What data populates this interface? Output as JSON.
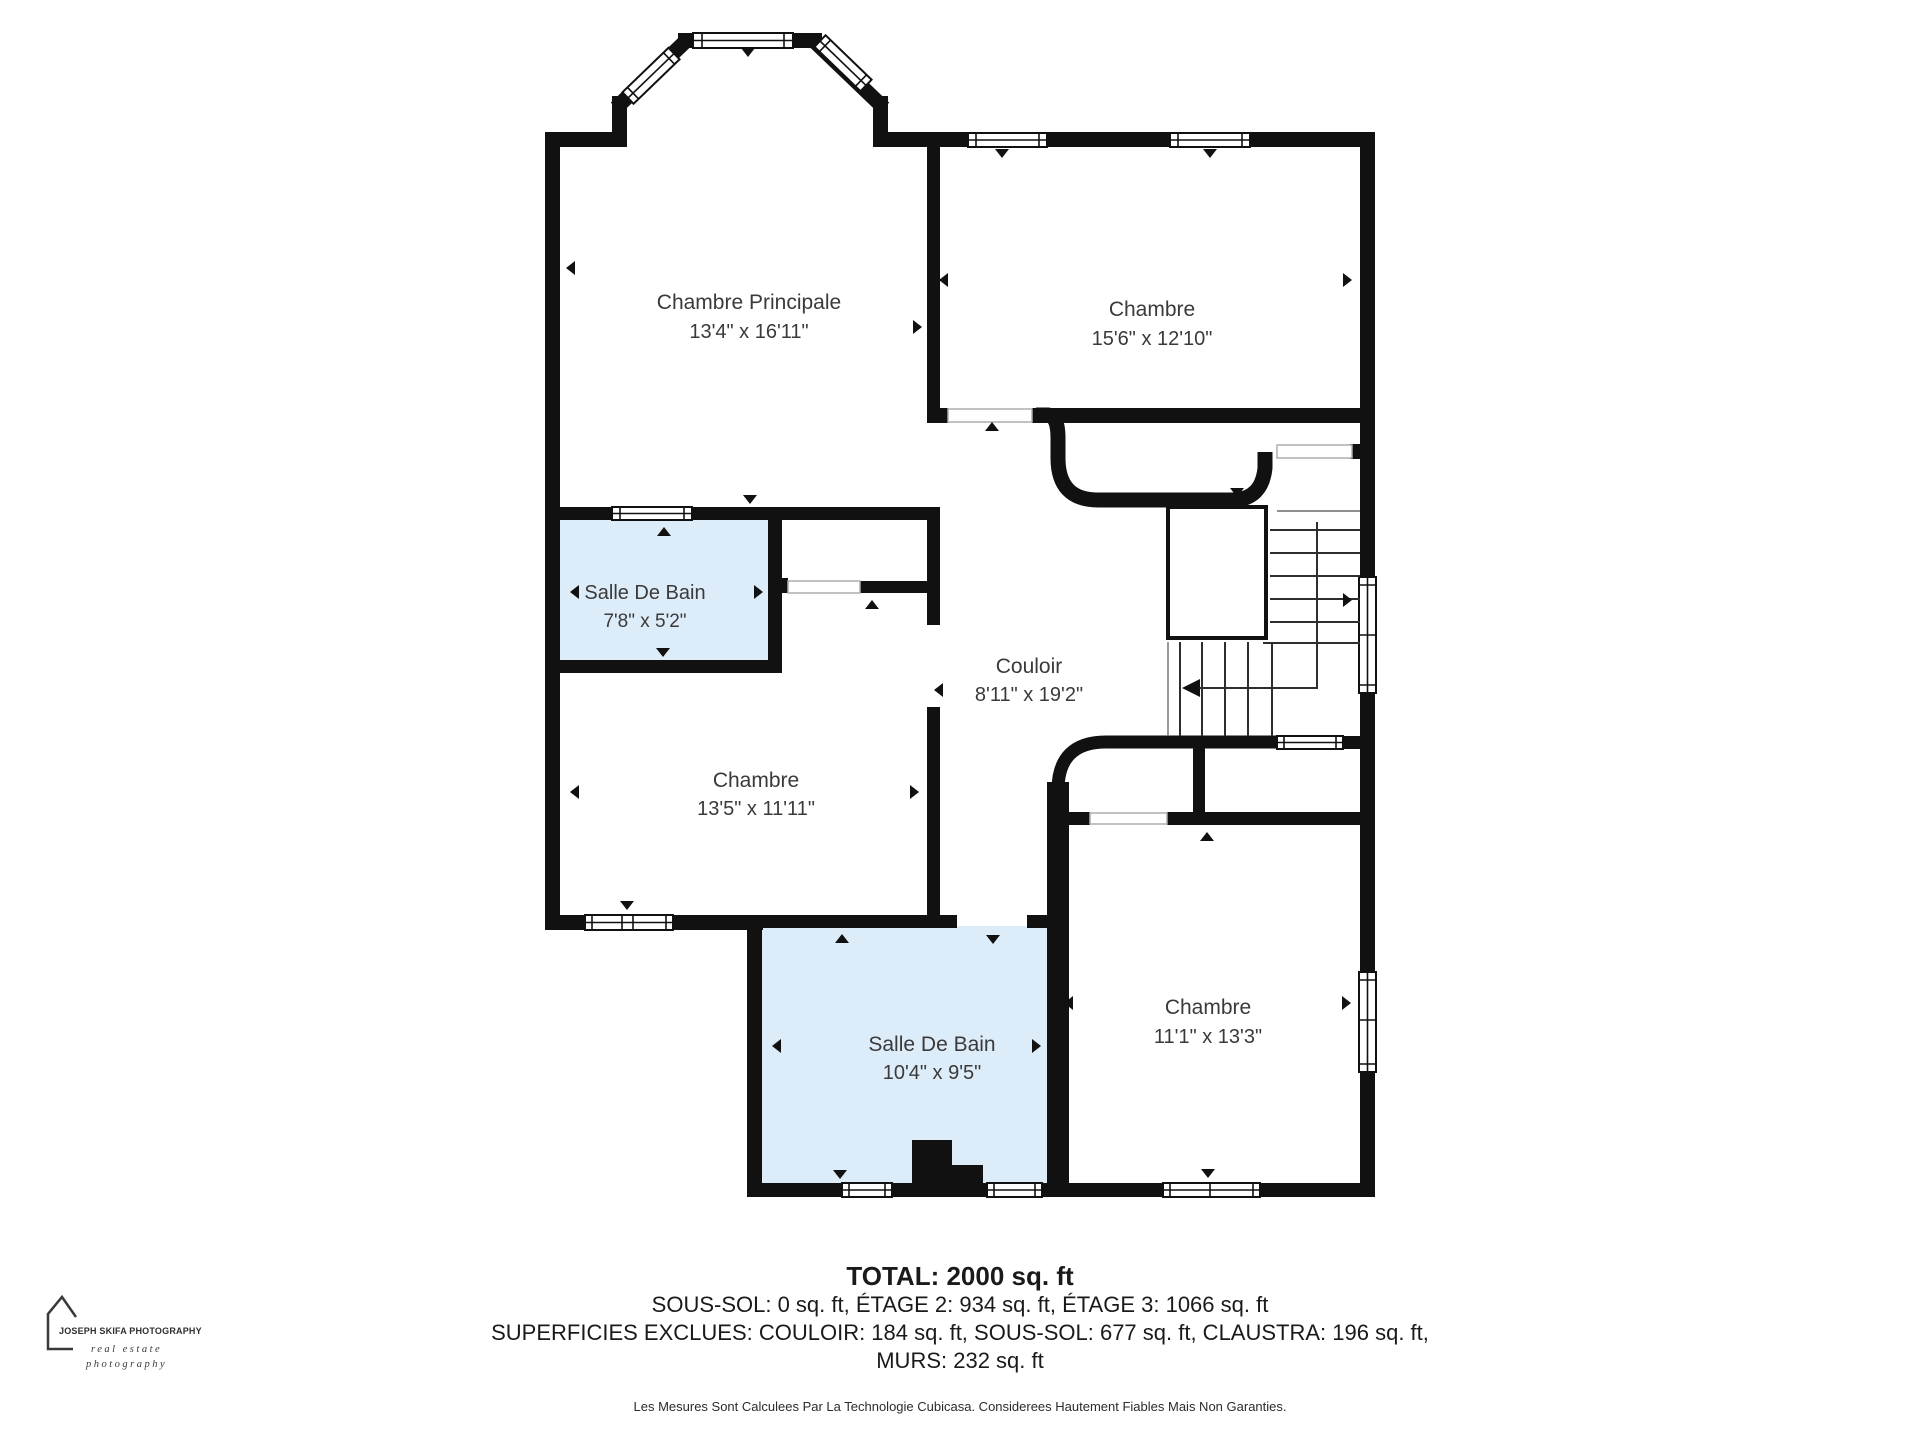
{
  "colors": {
    "wall": "#111111",
    "bath": "#ddecf9",
    "text": "#3a3a3a",
    "stair": "#2e2e2e",
    "opening": "#adadad"
  },
  "rooms": {
    "chambre_principale": {
      "name": "Chambre Principale",
      "dims": "13'4\" x 16'11\""
    },
    "chambre_top_right": {
      "name": "Chambre",
      "dims": "15'6\" x 12'10\""
    },
    "salle_de_bain_top": {
      "name": "Salle De Bain",
      "dims": "7'8\" x 5'2\""
    },
    "couloir": {
      "name": "Couloir",
      "dims": "8'11\" x 19'2\""
    },
    "chambre_mid_left": {
      "name": "Chambre",
      "dims": "13'5\" x 11'11\""
    },
    "salle_de_bain_bottom": {
      "name": "Salle De Bain",
      "dims": "10'4\" x 9'5\""
    },
    "chambre_bottom_right": {
      "name": "Chambre",
      "dims": "11'1\" x 13'3\""
    }
  },
  "footer": {
    "total": "TOTAL: 2000 sq. ft",
    "line2": "SOUS-SOL: 0 sq. ft, ÉTAGE 2: 934 sq. ft, ÉTAGE 3: 1066 sq. ft",
    "line3": "SUPERFICIES EXCLUES: COULOIR: 184 sq. ft, SOUS-SOL: 677 sq. ft, CLAUSTRA: 196 sq. ft,",
    "line4": "MURS: 232 sq. ft",
    "disclaimer": "Les Mesures Sont Calculees Par La Technologie Cubicasa. Considerees Hautement Fiables Mais Non Garanties."
  },
  "logo": {
    "title": "JOSEPH SKIFA PHOTOGRAPHY",
    "subtitle1": "real estate",
    "subtitle2": "photography"
  }
}
